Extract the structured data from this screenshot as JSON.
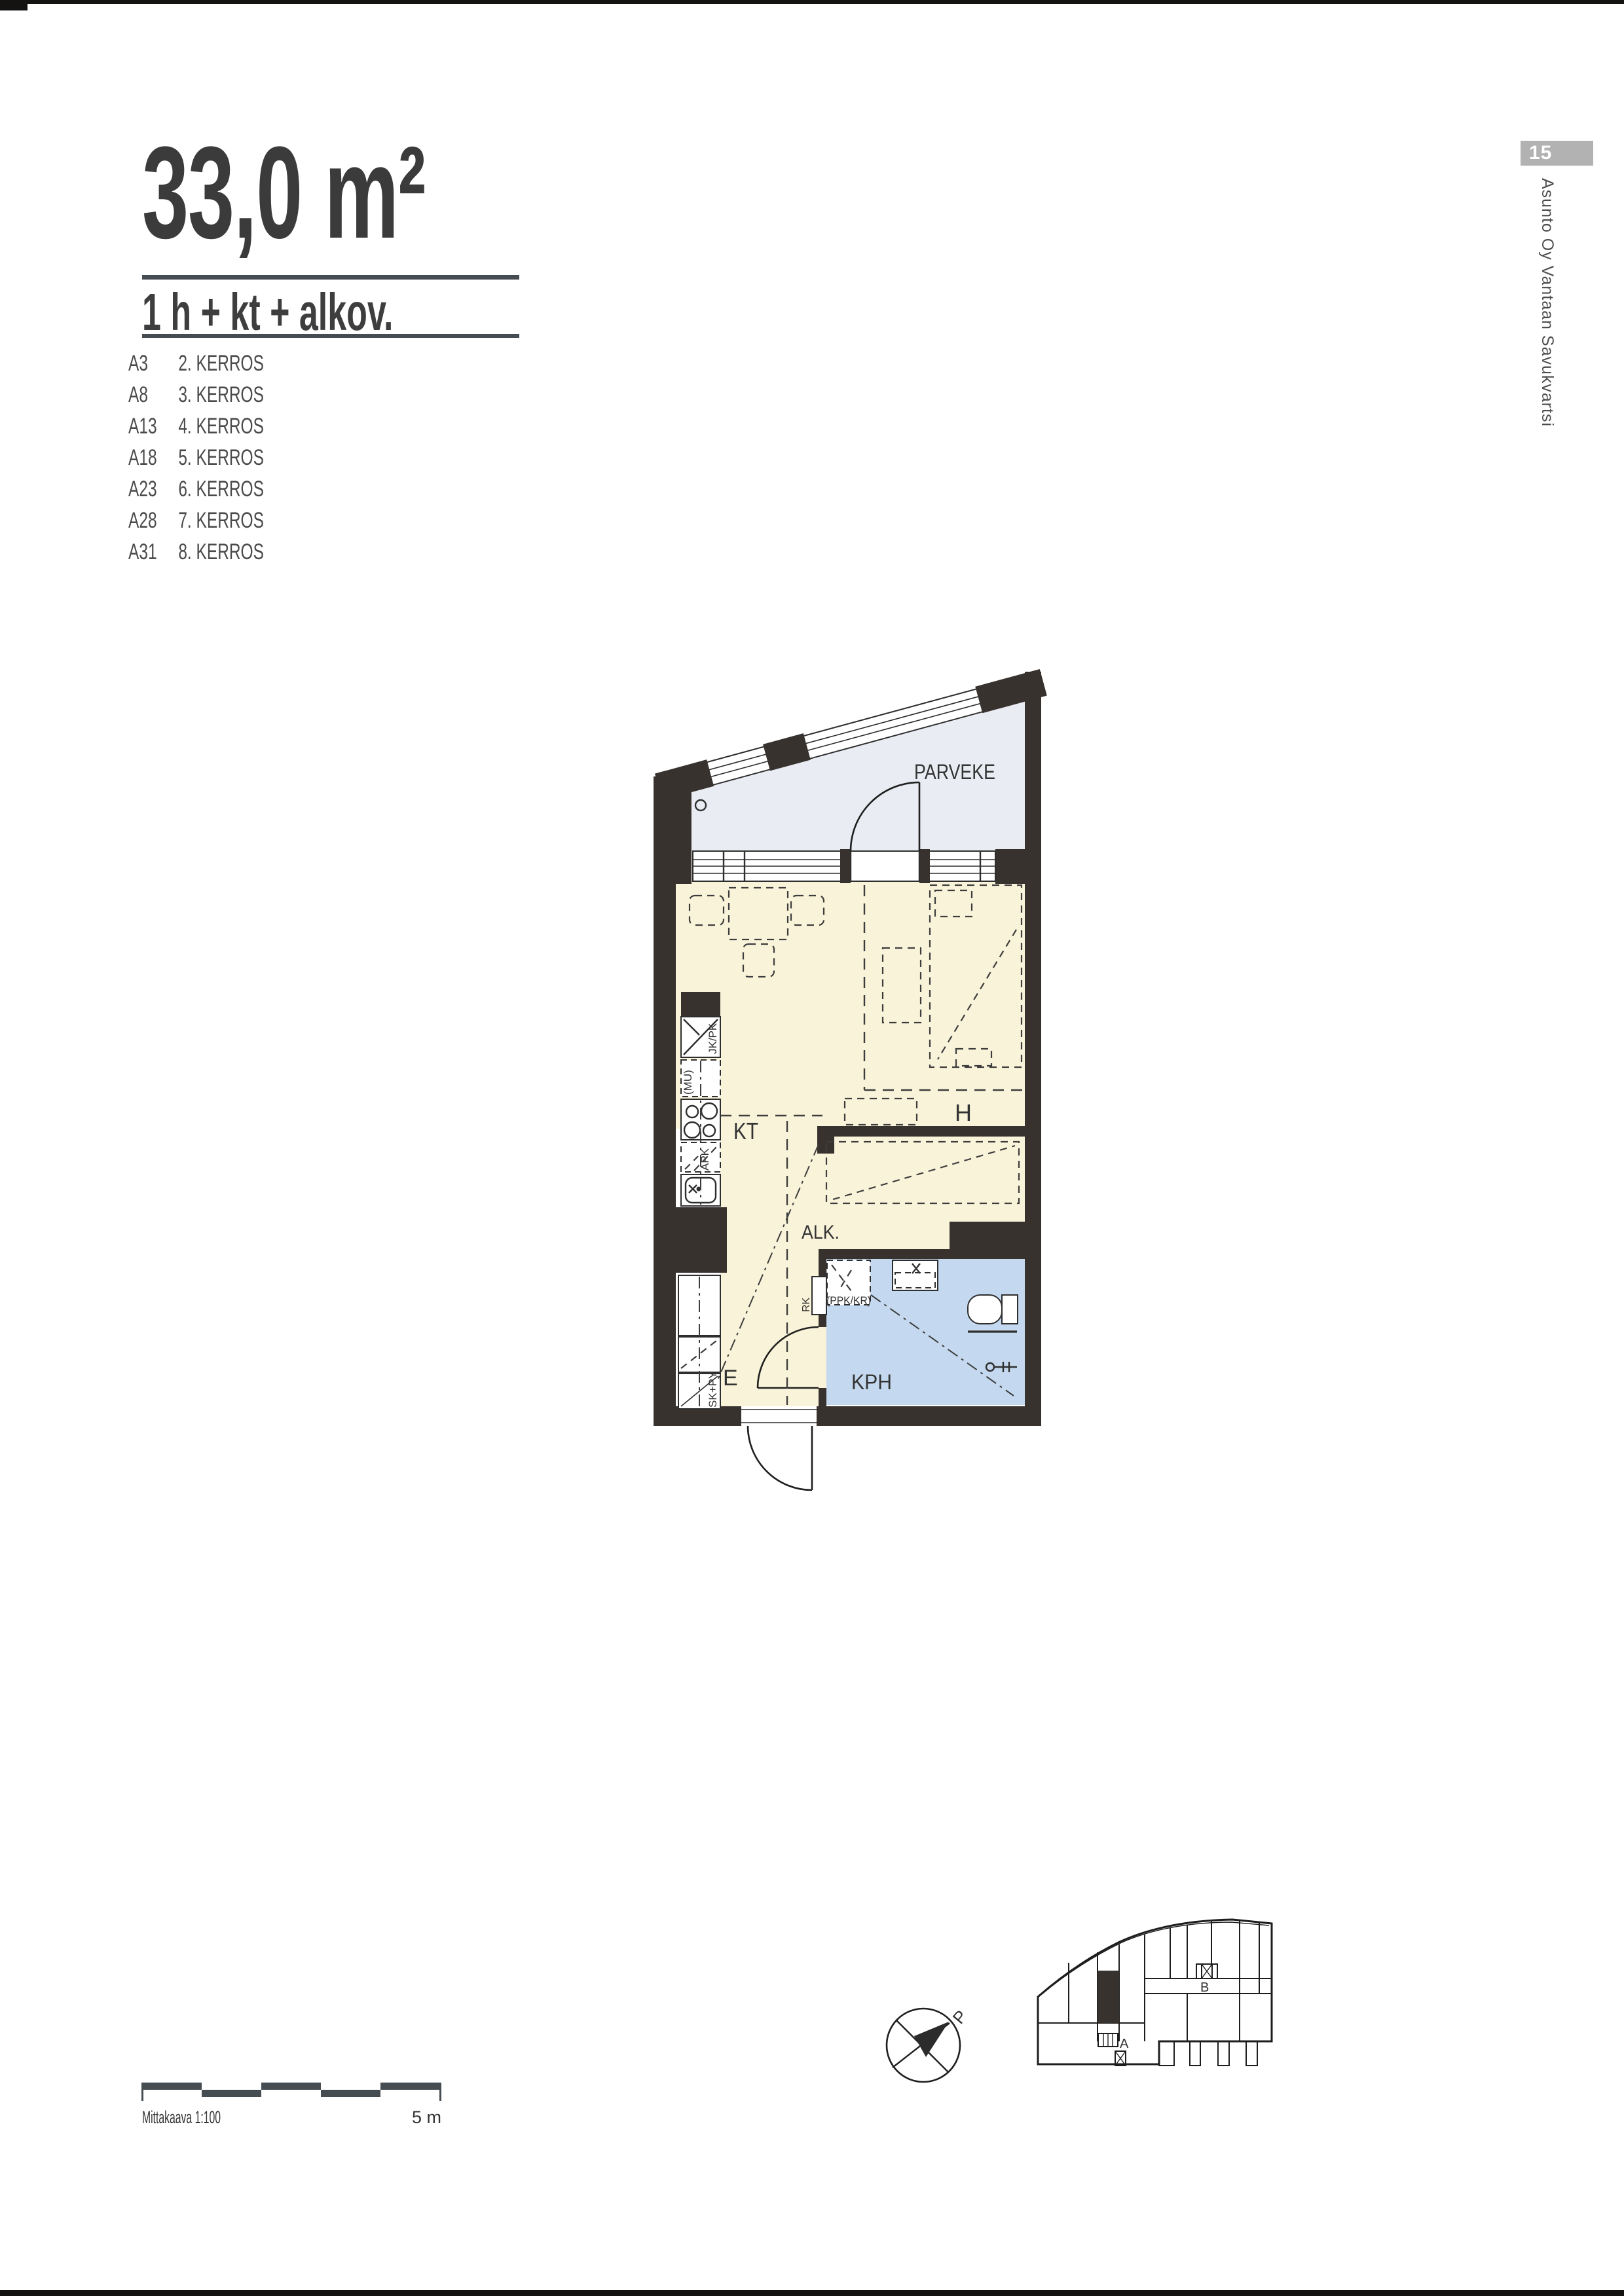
{
  "header": {
    "area_label": "33,0 m²",
    "type_label": "1 h + kt + alkov."
  },
  "apartments": {
    "rows": [
      {
        "code": "A3",
        "floor": "2. KERROS"
      },
      {
        "code": "A8",
        "floor": "3. KERROS"
      },
      {
        "code": "A13",
        "floor": "4. KERROS"
      },
      {
        "code": "A18",
        "floor": "5. KERROS"
      },
      {
        "code": "A23",
        "floor": "6. KERROS"
      },
      {
        "code": "A28",
        "floor": "7. KERROS"
      },
      {
        "code": "A31",
        "floor": "8. KERROS"
      }
    ]
  },
  "page": {
    "badge": "15",
    "side_text": "Asunto Oy Vantaan Savukvartsi"
  },
  "plan": {
    "labels": {
      "balcony": "PARVEKE",
      "kitchenette": "KT",
      "room": "H",
      "alcove": "ALK.",
      "bathroom": "KPH",
      "entry": "E",
      "fridge": "JK/PK",
      "microwave": "(MU)",
      "dishwasher": "APK",
      "closet": "SK+PY",
      "electrical": "RK",
      "washer_reserve": "(PPK/KR)"
    }
  },
  "keyplan": {
    "stair_a": "A",
    "stair_b": "B"
  },
  "compass": {
    "north": "P"
  },
  "scalebar": {
    "label": "Mittakaava 1:100",
    "right_label": "5 m"
  },
  "colors": {
    "wall": "#38322e",
    "cream": "#f8f3d9",
    "blue": "#c4d9ef",
    "balcony": "#e9ecf2",
    "badge": "#b2b2b2",
    "bar": "#454c52"
  }
}
